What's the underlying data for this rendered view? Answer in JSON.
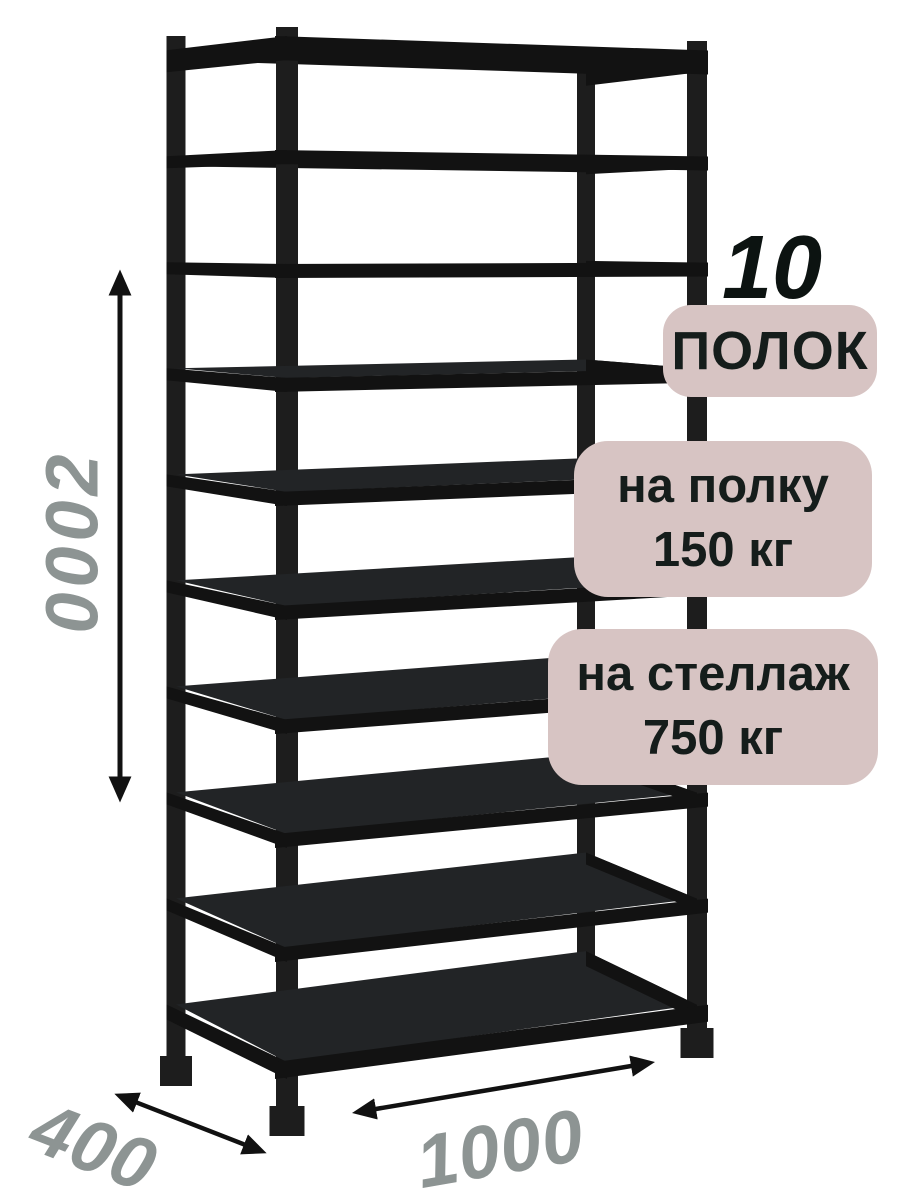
{
  "product": {
    "name": "metal-shelving-rack",
    "shelf_count": 10
  },
  "annotations": {
    "height": "2000",
    "depth": "400",
    "width": "1000",
    "shelf_count_number": "10",
    "shelf_count_label": "ПОЛОК",
    "shelf_load_line1": "на полку",
    "shelf_load_line2": "150 кг",
    "rack_load_line1": "на стеллаж",
    "rack_load_line2": "750 кг"
  },
  "colors": {
    "background": "#ffffff",
    "metal": "#1d1d1d",
    "metal_rail": "#121212",
    "metal_surface": "#222426",
    "badge_background": "#d7c4c3",
    "badge_text": "#151d1b",
    "count_number_text": "#0c1311",
    "dimension_text": "#8d9493",
    "arrow": "#111111"
  }
}
